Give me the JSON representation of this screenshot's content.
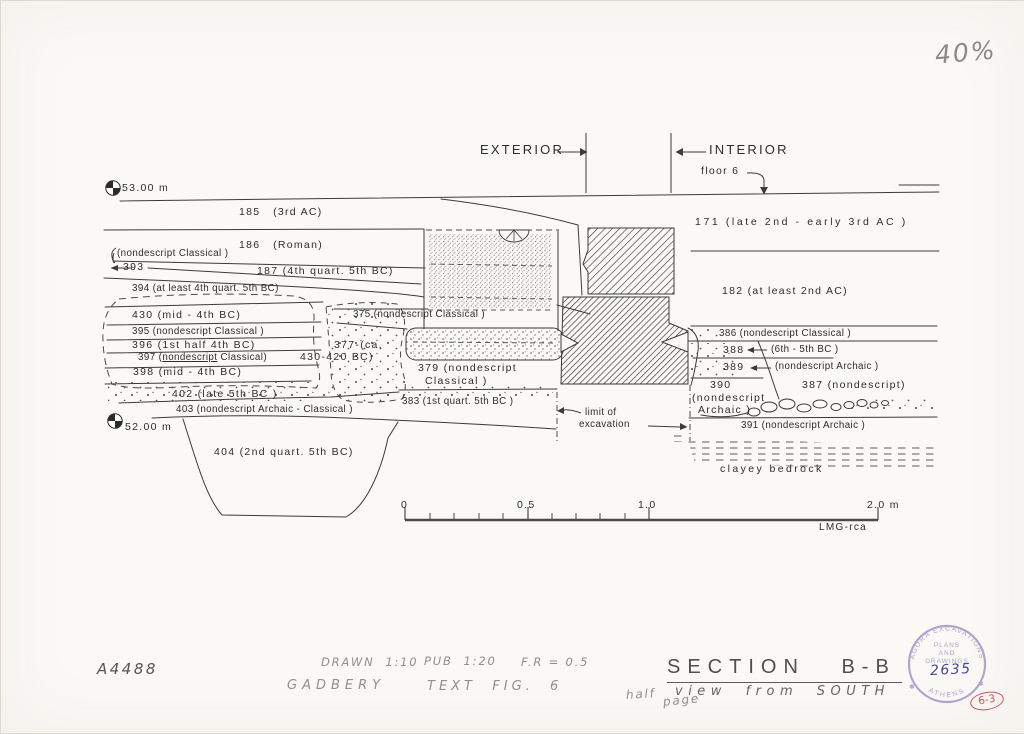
{
  "page": {
    "scale_note": "40%",
    "inventory_no": "A4488",
    "drawn": "DRAWN  1:10",
    "pub": "PUB  1:20",
    "fr": "F.R = 0.5",
    "author": "GADBERY",
    "figure": "TEXT  FIG.  6",
    "half1": "half",
    "half2": "page",
    "title": "SECTION B-B",
    "subtitle": "view from SOUTH",
    "stamp_no": "2635",
    "circle_ref": "6-3",
    "stamp": {
      "top": "AGORA EXCAVATIONS",
      "l1": "PLANS",
      "l2": "AND",
      "l3": "DRAWINGS",
      "bottom": "ATHENS",
      "star": "✱"
    }
  },
  "drawing": {
    "exterior": "EXTERIOR",
    "interior": "INTERIOR",
    "floor": "floor 6",
    "elev_top": "53.00 m",
    "elev_bottom": "52.00 m",
    "limit1": "limit of",
    "limit2": "excavation",
    "bedrock": "clayey bedrock"
  },
  "strata": {
    "s185": "185   (3rd AC)",
    "s186": "186   (Roman)",
    "s393_note": "(nondescript Classical )",
    "s393": "393",
    "s187": "187 (4th quart. 5th BC)",
    "s394": "394 (at least 4th quart. 5th BC)",
    "s430": "430 (mid - 4th BC)",
    "s395": "395 (nondescript Classical )",
    "s396": "396 (1st half 4th BC)",
    "s397_pre": "397 (",
    "s397_ul": "nondescript",
    "s397_post": " Classical)",
    "s398": "398 (mid - 4th BC)",
    "s375": "375 (nondescript Classical )",
    "s377a": "377-(ca.",
    "s377b": "430-420 BC)",
    "s379a": "379 (nondescript",
    "s379b": "Classical )",
    "s402": "402 (late 5th BC )",
    "s383": "383 (1st quart. 5th BC )",
    "s403": "403 (nondescript Archaic - Classical )",
    "s404": "404 (2nd quart. 5th BC)",
    "s171": "171 (late 2nd - early 3rd AC )",
    "s182": "182 (at least 2nd AC)",
    "s386": "386 (nondescript Classical )",
    "s388": "388",
    "s388_note": "(6th - 5th BC )",
    "s389": "389",
    "s389_note": "(nondescript Archaic )",
    "s390a": "390",
    "s390b": "(nondescript",
    "s390c": "Archaic )",
    "s387": "387 (nondescript)",
    "s391": "391 (nondescript Archaic )"
  },
  "scalebar": {
    "t0": "0",
    "t05": "0.5",
    "t10": "1.0",
    "t20": "2.0 m",
    "credit": "LMG-rca"
  },
  "colors": {
    "ink": "#3b3b3b",
    "pencil": "#8f8f8f",
    "stamp": "#9c8ec6",
    "red": "#cf4f63"
  }
}
